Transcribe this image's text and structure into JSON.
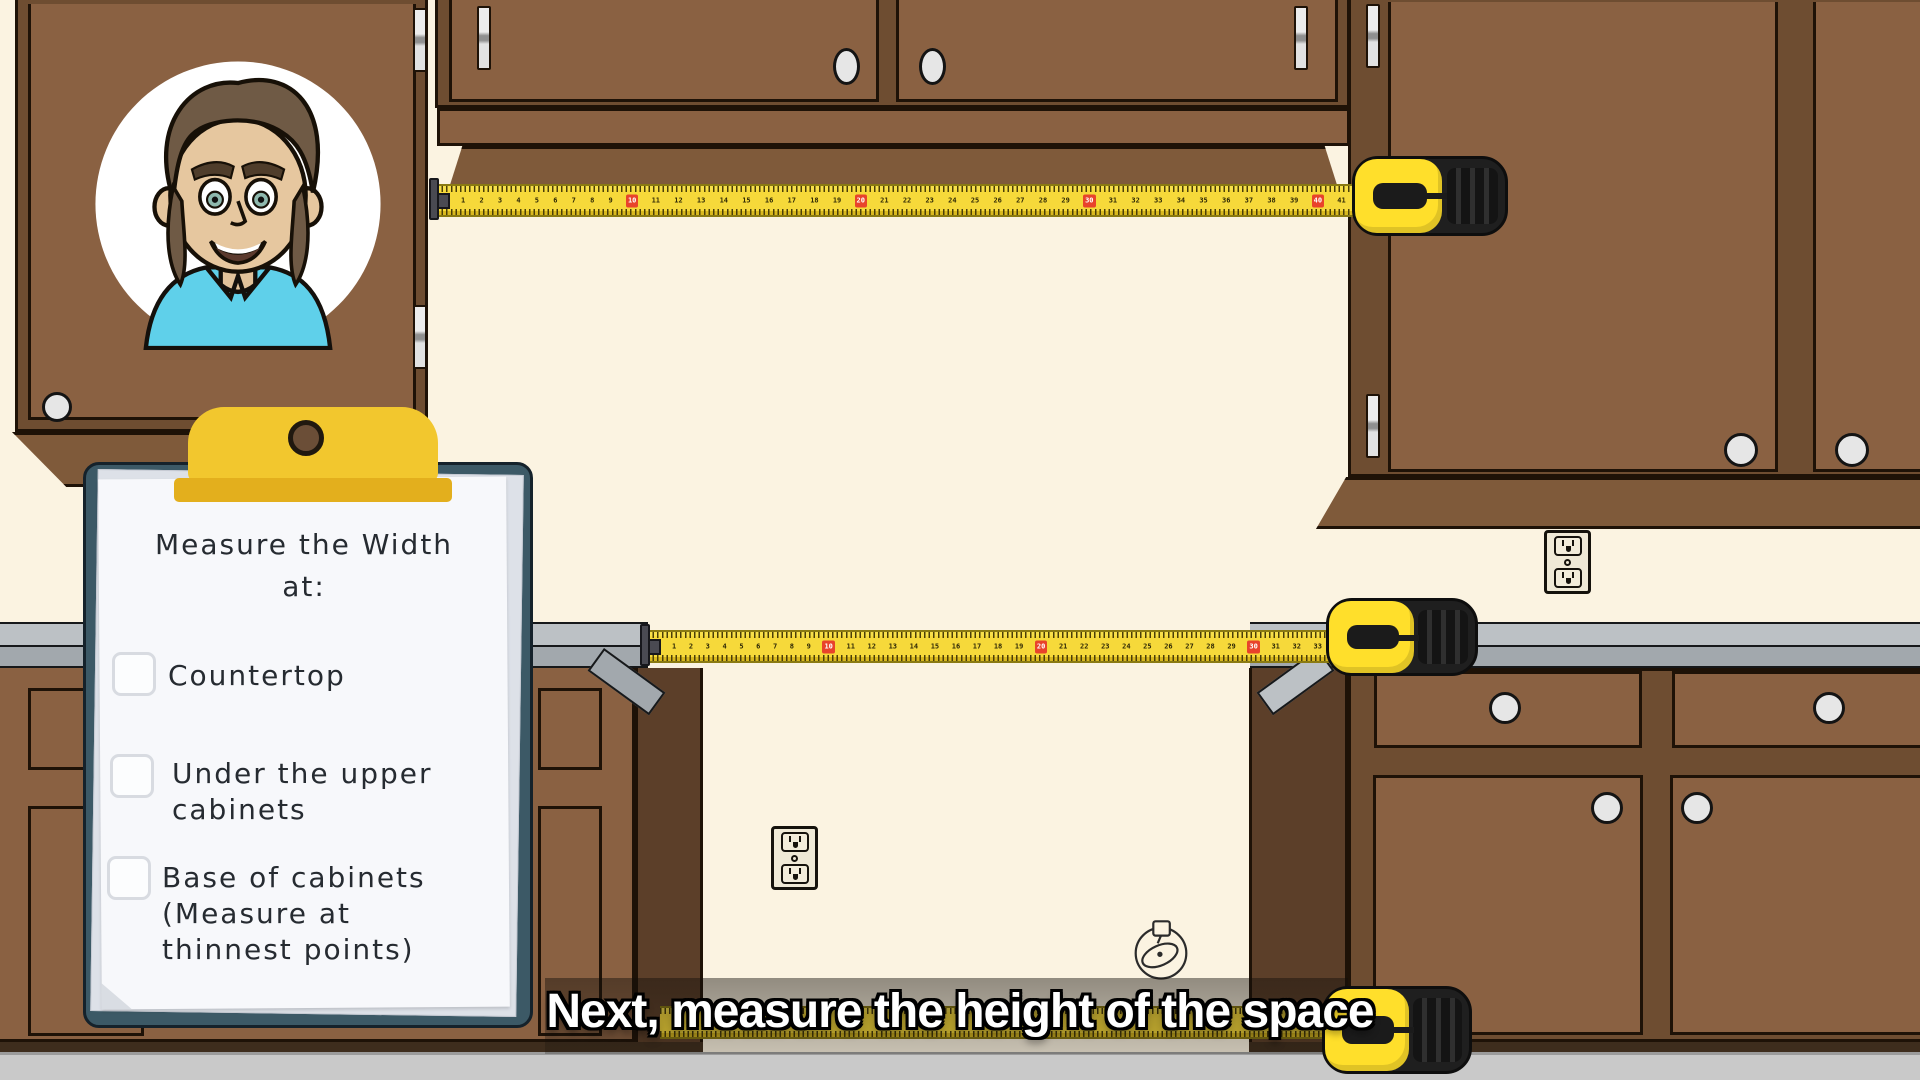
{
  "caption": {
    "text": "Next, measure the height of the space"
  },
  "clipboard": {
    "title": "Measure the Width\nat:",
    "items": [
      {
        "label": "Countertop",
        "checked": false
      },
      {
        "label": "Under the upper\ncabinets",
        "checked": false
      },
      {
        "label": "Base of cabinets\n(Measure at\nthinnest points)",
        "checked": false
      }
    ]
  },
  "tapes": {
    "upper": {
      "from": 1,
      "to": 41,
      "red_every": 10
    },
    "middle": {
      "from": 1,
      "to": 33,
      "red_every": 10
    },
    "bottom": {
      "from": 1,
      "to": 0,
      "red_every": 10
    }
  },
  "icons": {
    "avatar": "presenter-avatar",
    "outlet": "power-outlet-icon",
    "tape_outline": "tape-measure-outline-icon",
    "clip": "clipboard-clip",
    "checkbox": "checkbox-unchecked"
  },
  "colors": {
    "wall": "#FBF3E1",
    "floor": "#C9C9C9",
    "cabinet": "#8A6142",
    "cabinet_frame": "#6E4D31",
    "cabinet_dark": "#7F5A3A",
    "cabinet_side": "#5C3F29",
    "outline": "#1E1207",
    "counter_top": "#BCC1C5",
    "counter_front": "#A2A8AD",
    "clipboard": "#3C5966",
    "paper": "#F7F8FB",
    "clip_yellow": "#F2C72E",
    "clip_dark": "#E3AF1D",
    "tape_yellow": "#F6D93A",
    "tape_red": "#E8432B",
    "case_yellow": "#FFDF2B",
    "case_black": "#1F1F1F",
    "knob": "#E6E6E6",
    "ink": "#262B31"
  }
}
